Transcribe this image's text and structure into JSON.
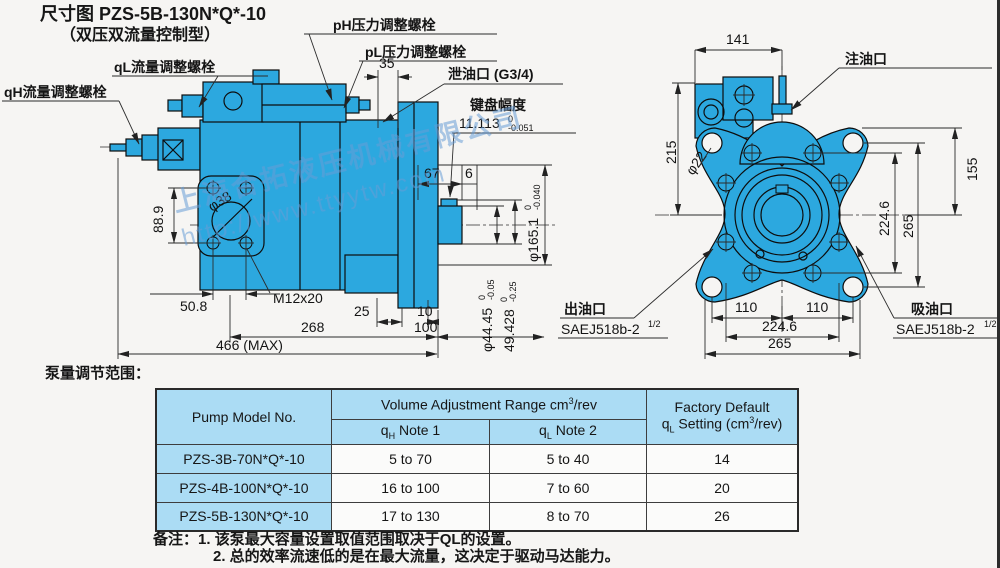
{
  "title": {
    "line1": "尺寸图 PZS-5B-130N*Q*-10",
    "line2": "（双压双流量控制型）"
  },
  "watermark": {
    "line1": "上海合拓液压机械有限公司",
    "line2": "http://www.ttyytw.com"
  },
  "side_view": {
    "labels": {
      "ql_screw": "qL流量调整螺栓",
      "qh_screw": "qH流量调整螺栓",
      "ph_screw": "pH压力调整螺栓",
      "pl_screw": "pL压力调整螺栓",
      "drain_port": "泄油口 (G3/4)",
      "key_width_label": "键盘幅度",
      "thread": "M12x20",
      "phi38": "φ38"
    },
    "dims": {
      "d35": "35",
      "d67": "67",
      "d6": "6",
      "d88_9": "88.9",
      "d50_8": "50.8",
      "d25": "25",
      "d10": "10",
      "d268": "268",
      "d100": "100",
      "d466": "466 (MAX)",
      "key_width": {
        "value": "11.113",
        "tol_upper": "0",
        "tol_lower": "-0.051"
      },
      "shaft_dia": {
        "value": "φ44.45",
        "tol_upper": "0",
        "tol_lower": "-0.05"
      },
      "key_height": {
        "value": "49.428",
        "tol_upper": "0",
        "tol_lower": "-0.25"
      },
      "pilot_dia": {
        "value": "φ165.1",
        "tol_upper": "0",
        "tol_lower": "-0.040"
      }
    }
  },
  "rear_view": {
    "labels": {
      "fill_port": "注油口",
      "outlet": "出油口",
      "outlet_spec": "SAEJ518b-2",
      "outlet_spec_sup": "1/2",
      "suction": "吸油口",
      "suction_spec": "SAEJ518b-2",
      "suction_spec_sup": "1/2",
      "phi22": "φ22"
    },
    "dims": {
      "d141": "141",
      "d215": "215",
      "d155": "155",
      "d224_6_v": "224.6",
      "d265_v": "265",
      "d110_l": "110",
      "d110_r": "110",
      "d224_6_h": "224.6",
      "d265_h": "265"
    }
  },
  "table_section": {
    "caption": "泵量调节范围：",
    "table": {
      "col1_header": "Pump Model No.",
      "group_header": {
        "text": "Volume Adjustment Range cm",
        "sup": "3",
        "rest": "/rev"
      },
      "sub1": {
        "base": "q",
        "sub": "H",
        "rest": " Note 1"
      },
      "sub2": {
        "base": "q",
        "sub": "L",
        "rest": " Note 2"
      },
      "col4_line1": "Factory Default",
      "col4_line2": {
        "base": "q",
        "sub": "L",
        "rest": " Setting (cm",
        "sup": "3",
        "rest2": "/rev)"
      },
      "rows": [
        {
          "model": "PZS-3B-70N*Q*-10",
          "qh": "5 to 70",
          "ql": "5 to 40",
          "factory_default": "14"
        },
        {
          "model": "PZS-4B-100N*Q*-10",
          "qh": "16 to 100",
          "ql": "7 to 60",
          "factory_default": "20"
        },
        {
          "model": "PZS-5B-130N*Q*-10",
          "qh": "17 to 130",
          "ql": "8 to 70",
          "factory_default": "26"
        }
      ]
    },
    "notes": {
      "label": "备注：",
      "note1": "1. 该泵最大容量设置取值范围取决于QL的设置。",
      "note2": "2. 总的效率流速低的是在最大流量，这决定于驱动马达能力。"
    }
  },
  "colors": {
    "pump_blue": "#2ca8df",
    "table_header_blue": "#abdcf4",
    "watermark_blue": "#689cd6",
    "line": "#2b2b2b"
  }
}
